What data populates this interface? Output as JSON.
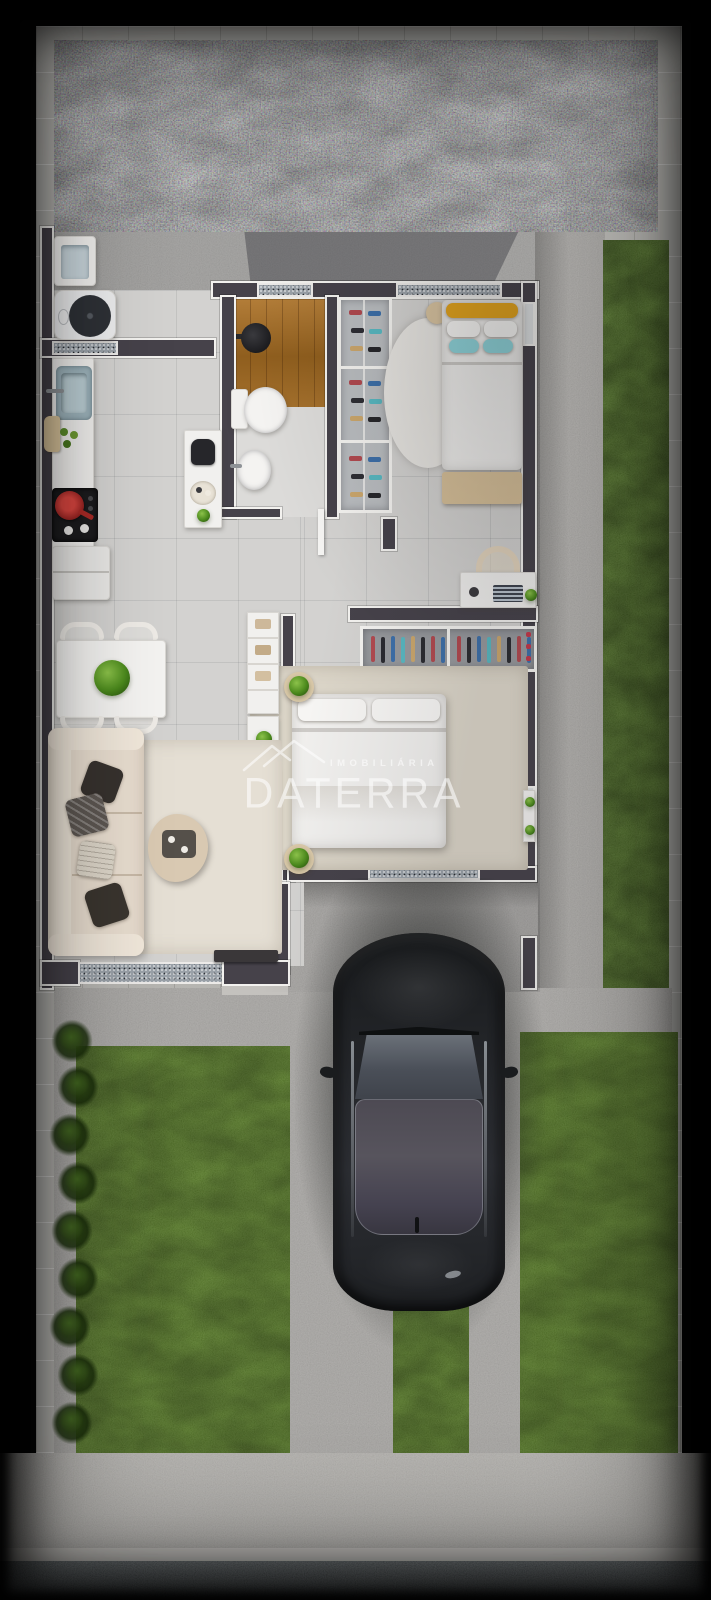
{
  "watermark": {
    "brand_top": "IMOBILIÁRIA",
    "brand_main": "DATERRA",
    "logo_icon": "roof-chevrons"
  },
  "palette": {
    "vignette": "#000000",
    "paver_border": "#b6b5b1",
    "gravel": "#6a707a",
    "concrete_patio": "#9c9b99",
    "concrete_front": "#a5a3a0",
    "sidewalk": "#b2b0ac",
    "asphalt_street": "#3d474b",
    "grass": "#4a7411",
    "wall": "#46424a",
    "wall_trim": "#f3f2ef",
    "floor_tile": "#d3d2d0",
    "wood_deck": "#a8732e",
    "sofa_beige": "#e9dfd2",
    "pillow_yellow": "#e2a31d",
    "pillow_teal": "#8fd4da",
    "pan_red": "#c23430",
    "car_body": "#222527",
    "car_glass": "#54515b",
    "watermark_text": "#ffffff"
  },
  "scene": {
    "view": "top-down 3D render of a single-storey house lot",
    "areas": [
      "backyard gravel strip",
      "service patio with laundry tub and washing machine",
      "kitchen",
      "bathroom with wood shower deck",
      "shoe closet",
      "bedroom 1 with desk",
      "hallway",
      "bedroom 2 with wardrobe rail",
      "living and dining room",
      "carport driveway with parked dark sedan",
      "front lawns with hedge row",
      "sidewalk",
      "street"
    ],
    "vehicle": "dark sedan parked facing the house, top view"
  }
}
